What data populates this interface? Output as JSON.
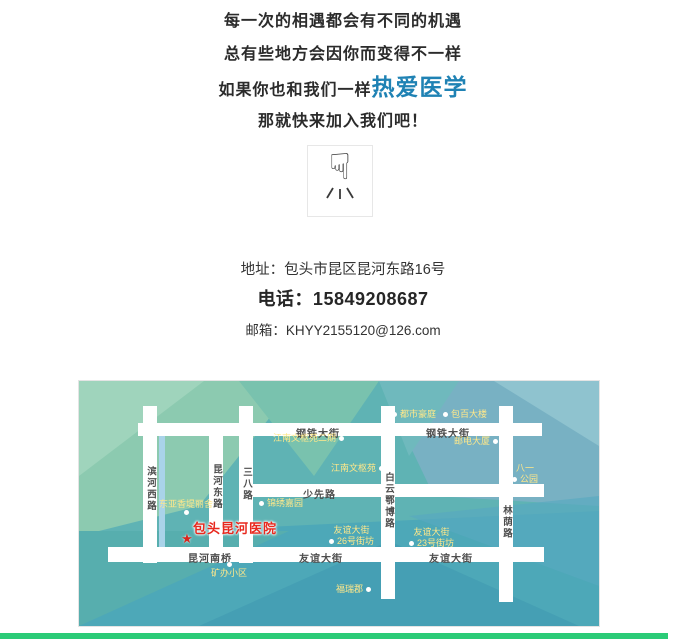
{
  "intro": {
    "line1": "每一次的相遇都会有不同的机遇",
    "line2": "总有些地方会因你而变得不一样",
    "line3_prefix": "如果你也和我们一样",
    "line3_highlight": "热爱医学",
    "line4": "那就快来加入我们吧！",
    "highlight_color": "#1f82b4"
  },
  "pointer": {
    "icon": "backhand-index-pointing-down-icon",
    "glyph": "☟"
  },
  "contact": {
    "address": "地址：包头市昆区昆河东路16号",
    "phone": "电话：15849208687",
    "email": "邮箱：KHYY2155120@126.com"
  },
  "map": {
    "hospital": {
      "name": "包头昆河医院",
      "marker": "red-star",
      "marker_glyph": "★",
      "color": "#e8281e"
    },
    "road_labels": {
      "gangtie_left": "钢铁大街",
      "gangtie_right": "钢铁大街",
      "shaoxian": "少先路",
      "kunhe_nanqiao": "昆河南桥",
      "youyi_center": "友谊大街",
      "youyi_right": "友谊大街",
      "binhe_xi": "滨河西路",
      "kunhe_dong": "昆河东路",
      "sanba": "三八路",
      "baiyun_ebo": "白云鄂博路",
      "linyin": "林荫路"
    },
    "pois": [
      {
        "text": "都市豪庭"
      },
      {
        "text": "包百大楼"
      },
      {
        "text": "邮电大厦"
      },
      {
        "text": "江南文枢苑二期"
      },
      {
        "text": "江南文枢苑"
      },
      {
        "line1": "八一",
        "line2": "公园"
      },
      {
        "text": "锦绣嘉园"
      },
      {
        "text": "东亚香堤丽舍"
      },
      {
        "line1": "友谊大街",
        "line2": "26号街坊"
      },
      {
        "line1": "友谊大街",
        "line2": "23号街坊"
      },
      {
        "text": "矿办小区"
      },
      {
        "text": "福瑞郡"
      }
    ],
    "poi_color": "#ffe88a"
  },
  "footer": {
    "bar_color": "#2bcb77"
  }
}
